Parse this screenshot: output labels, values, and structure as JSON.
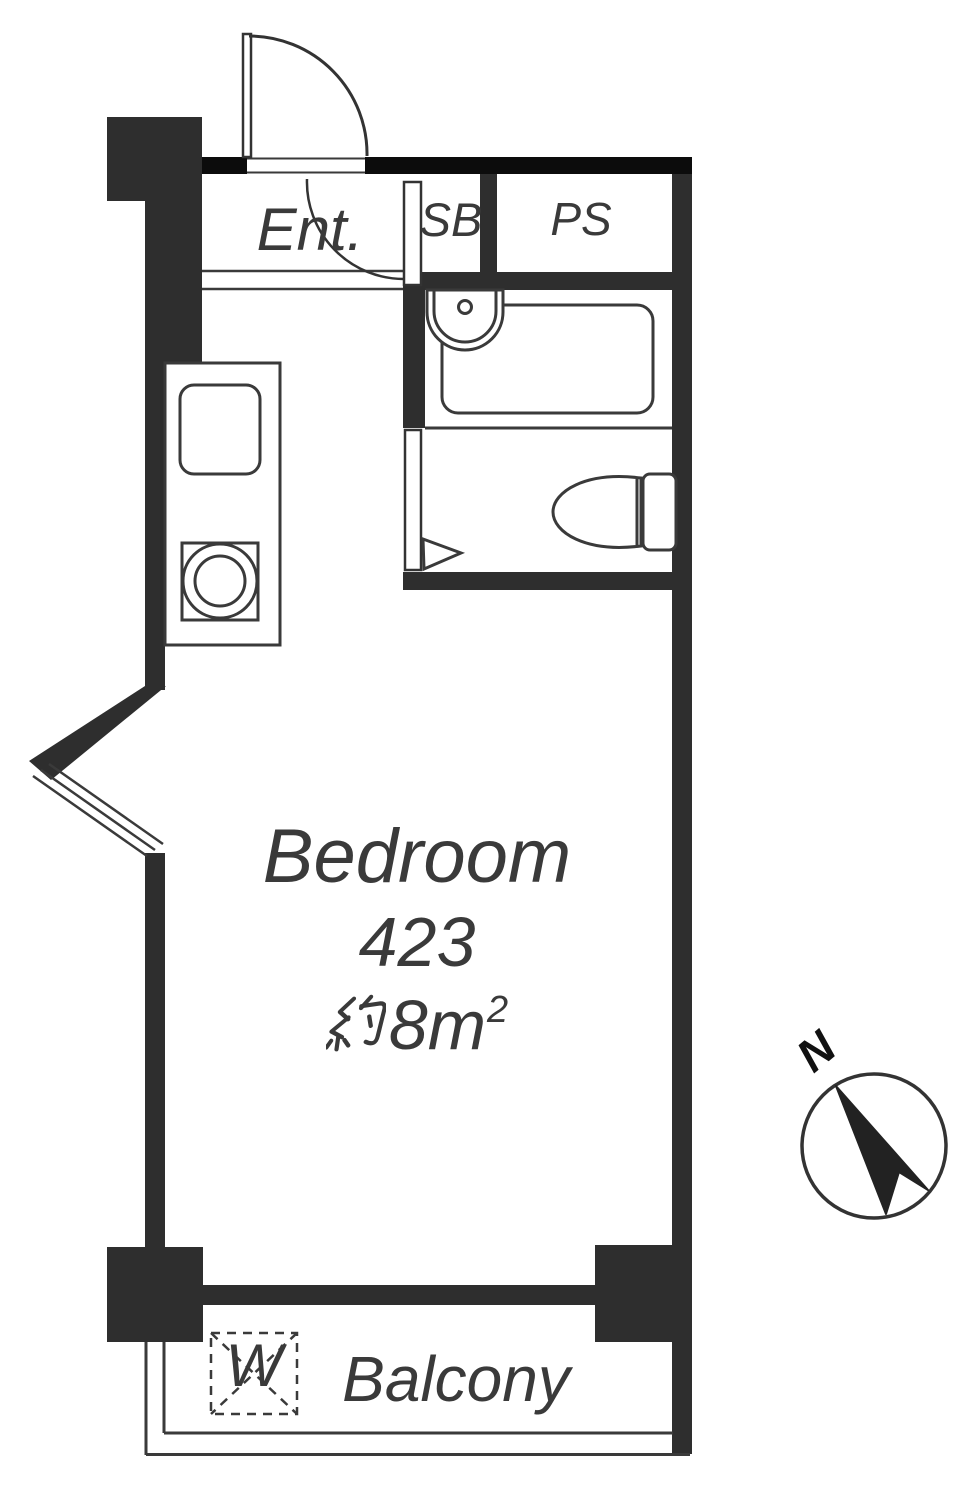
{
  "plan": {
    "type": "apartment-floor-plan",
    "rooms": {
      "entrance_label": "Ent.",
      "shoe_box_label": "SB",
      "pipe_space_label": "PS",
      "bedroom_name": "Bedroom",
      "bedroom_unit": "423",
      "bedroom_area_full": "約8m²",
      "bedroom_area_main": "8m",
      "bedroom_area_sup": "2",
      "balcony_label": "Balcony",
      "washer_label": "W"
    },
    "compass": {
      "north_label": "N"
    },
    "colors": {
      "wall": "#2e2e2e",
      "wall_top": "#0c0c0c",
      "line": "#3a3a3a",
      "text": "#3a3a3a",
      "background": "#ffffff"
    }
  }
}
